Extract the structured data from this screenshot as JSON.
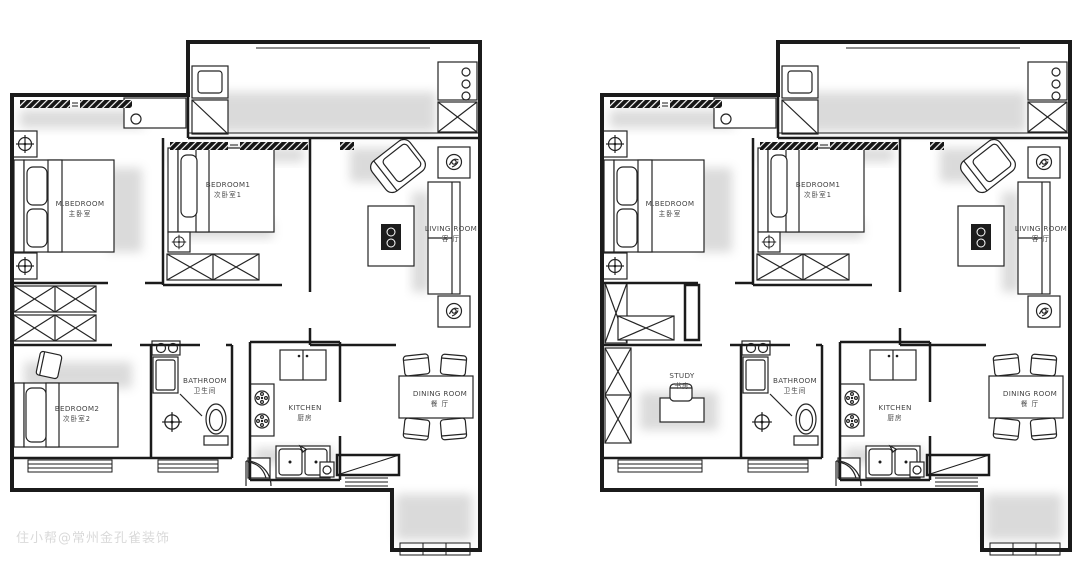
{
  "meta": {
    "watermark": "住小帮@常州金孔雀装饰"
  },
  "colors": {
    "background": "#ffffff",
    "line": "#1b1b1b",
    "label": "#454545",
    "shadow": "#8f8f8f",
    "watermark_gray": "#bdbdbd"
  },
  "icons": {
    "ceiling-lamp-icon": "circle-crosshair",
    "plant-icon": "circle-sprout",
    "stove-burner-icon": "burner-circle",
    "wardrobe-x-icon": "crossed-box",
    "shower-icon": "circle-crosshair"
  },
  "plans": [
    {
      "rooms": {
        "m_bedroom": {
          "en": "M.BEDROOM",
          "zh": "主卧室"
        },
        "bedroom1": {
          "en": "BEDROOM1",
          "zh": "次卧室1"
        },
        "living": {
          "en": "LIVING ROOM",
          "zh": "客 厅"
        },
        "bedroom2": {
          "en": "BEDROOM2",
          "zh": "次卧室2"
        },
        "bathroom": {
          "en": "BATHROOM",
          "zh": "卫生间"
        },
        "kitchen": {
          "en": "KITCHEN",
          "zh": "厨房"
        },
        "dining": {
          "en": "DINING ROOM",
          "zh": "餐 厅"
        }
      }
    },
    {
      "rooms": {
        "m_bedroom": {
          "en": "M.BEDROOM",
          "zh": "主卧室"
        },
        "bedroom1": {
          "en": "BEDROOM1",
          "zh": "次卧室1"
        },
        "living": {
          "en": "LIVING ROOM",
          "zh": "客 厅"
        },
        "study": {
          "en": "STUDY",
          "zh": "书房"
        },
        "bathroom": {
          "en": "BATHROOM",
          "zh": "卫生间"
        },
        "kitchen": {
          "en": "KITCHEN",
          "zh": "厨房"
        },
        "dining": {
          "en": "DINING ROOM",
          "zh": "餐 厅"
        }
      }
    }
  ]
}
